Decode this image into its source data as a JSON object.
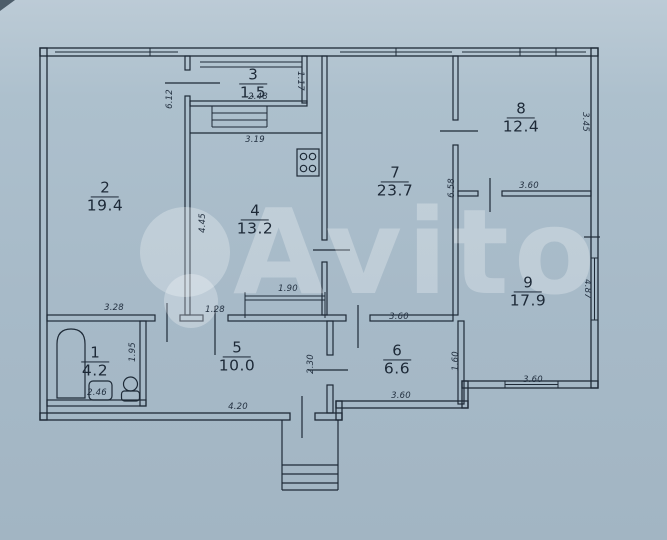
{
  "watermark": {
    "brand": "Avito",
    "color": "rgba(255,255,255,0.27)",
    "dots": [
      {
        "x": 185,
        "y": 252,
        "r": 45
      },
      {
        "x": 191,
        "y": 301,
        "r": 27
      }
    ],
    "text_x": 233,
    "text_y": 193,
    "font_size": 118
  },
  "palette": {
    "paper": "#a7bac8",
    "ink": "#1e2a37"
  },
  "rooms": [
    {
      "number": "1",
      "area": "4.2",
      "x": 95,
      "y": 361
    },
    {
      "number": "2",
      "area": "19.4",
      "x": 105,
      "y": 196
    },
    {
      "number": "3",
      "area": "1.5",
      "x": 253,
      "y": 83
    },
    {
      "number": "4",
      "area": "13.2",
      "x": 255,
      "y": 219
    },
    {
      "number": "5",
      "area": "10.0",
      "x": 237,
      "y": 356
    },
    {
      "number": "6",
      "area": "6.6",
      "x": 397,
      "y": 359
    },
    {
      "number": "7",
      "area": "23.7",
      "x": 395,
      "y": 181
    },
    {
      "number": "8",
      "area": "12.4",
      "x": 521,
      "y": 117
    },
    {
      "number": "9",
      "area": "17.9",
      "x": 528,
      "y": 291
    }
  ],
  "dimensions": {
    "horizontal": [
      {
        "text": "3.28",
        "x": 114,
        "y": 308
      },
      {
        "text": "2.46",
        "x": 97,
        "y": 393
      },
      {
        "text": "2.48",
        "x": 258,
        "y": 97
      },
      {
        "text": "3.19",
        "x": 255,
        "y": 140
      },
      {
        "text": "1.90",
        "x": 288,
        "y": 289
      },
      {
        "text": "1.28",
        "x": 215,
        "y": 310
      },
      {
        "text": "4.20",
        "x": 238,
        "y": 407
      },
      {
        "text": "3.60",
        "x": 399,
        "y": 317
      },
      {
        "text": "3.60",
        "x": 401,
        "y": 396
      },
      {
        "text": "3.60",
        "x": 529,
        "y": 186
      },
      {
        "text": "3.60",
        "x": 533,
        "y": 380
      }
    ],
    "vertical": [
      {
        "text": "6.12",
        "x": 170,
        "y": 99,
        "dir": "ccw"
      },
      {
        "text": "4.45",
        "x": 203,
        "y": 223,
        "dir": "ccw"
      },
      {
        "text": "1.95",
        "x": 133,
        "y": 352,
        "dir": "ccw"
      },
      {
        "text": "2.30",
        "x": 311,
        "y": 364,
        "dir": "ccw"
      },
      {
        "text": "6.58",
        "x": 452,
        "y": 188,
        "dir": "ccw"
      },
      {
        "text": "1.60",
        "x": 456,
        "y": 361,
        "dir": "ccw"
      },
      {
        "text": "1.17",
        "x": 300,
        "y": 81,
        "dir": "cw"
      },
      {
        "text": "3.45",
        "x": 585,
        "y": 122,
        "dir": "cw"
      },
      {
        "text": "4.87",
        "x": 587,
        "y": 289,
        "dir": "cw"
      }
    ]
  },
  "fixtures": [
    "bathtub",
    "sink",
    "toilet",
    "stove",
    "entrance-steps"
  ]
}
